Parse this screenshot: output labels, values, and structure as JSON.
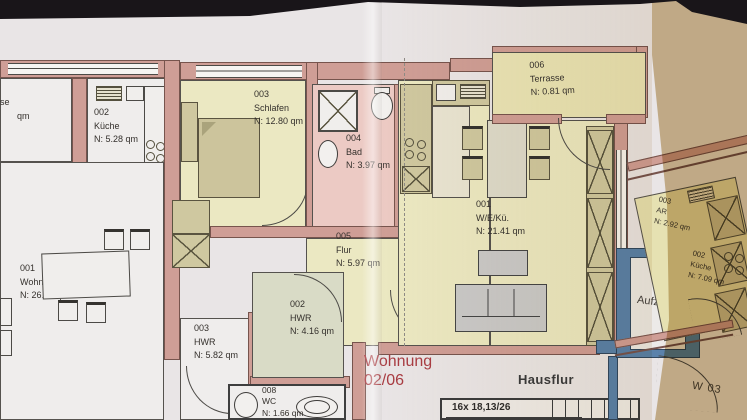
{
  "scene": {
    "description": "Photo of a paper architectural floor plan, right side in fold shadow",
    "plan_type": "floor-plan"
  },
  "rooms": {
    "kueche_left": {
      "num": "002",
      "name": "Küche",
      "area": "N: 5.28 qm"
    },
    "wohnen_essen": {
      "num": "001",
      "name": "Wohnen/Essen",
      "area": "N: 26.45 qm"
    },
    "hwr_left": {
      "num": "003",
      "name": "HWR",
      "area": "N: 5.82 qm"
    },
    "wc": {
      "num": "008",
      "name": "WC",
      "area": "N: 1.66 qm"
    },
    "schlafen": {
      "num": "003",
      "name": "Schlafen",
      "area": "N: 12.80 qm"
    },
    "bad": {
      "num": "004",
      "name": "Bad",
      "area": "N: 3.97 qm"
    },
    "flur": {
      "num": "005",
      "name": "Flur",
      "area": "N: 5.97 qm"
    },
    "hwr_mid": {
      "num": "002",
      "name": "HWR",
      "area": "N: 4.16 qm"
    },
    "weku": {
      "num": "001",
      "name": "W/E/Kü.",
      "area": "N: 21.41 qm"
    },
    "terrasse": {
      "num": "006",
      "name": "Terrasse",
      "area": "N: 0.81 qm"
    },
    "ar_right": {
      "num": "003",
      "name": "AR",
      "area": "N: 2.92 qm"
    },
    "kueche_right": {
      "num": "002",
      "name": "Küche",
      "area": "N: 7.09 qm"
    }
  },
  "labels": {
    "wohnung1": "Wohnung",
    "wohnung2": "02/06",
    "hausflur": "Hausflur",
    "aufzug": "Aufzug",
    "stairs": "16x 18,13/26",
    "w03": "W 03",
    "partial1": "se",
    "partial2": "qm"
  },
  "colors": {
    "paper": "#e9e5e6",
    "wall_rose": "#cf9e96",
    "room_yellow": "#ebe8c2",
    "room_pink": "#eccac4",
    "room_green": "#d9dbc6",
    "elevator_blue": "#5b82ab",
    "red_text": "#a93c42",
    "shadow_tan": "#c9b48f",
    "furniture_khaki": "#cfc8a0"
  }
}
